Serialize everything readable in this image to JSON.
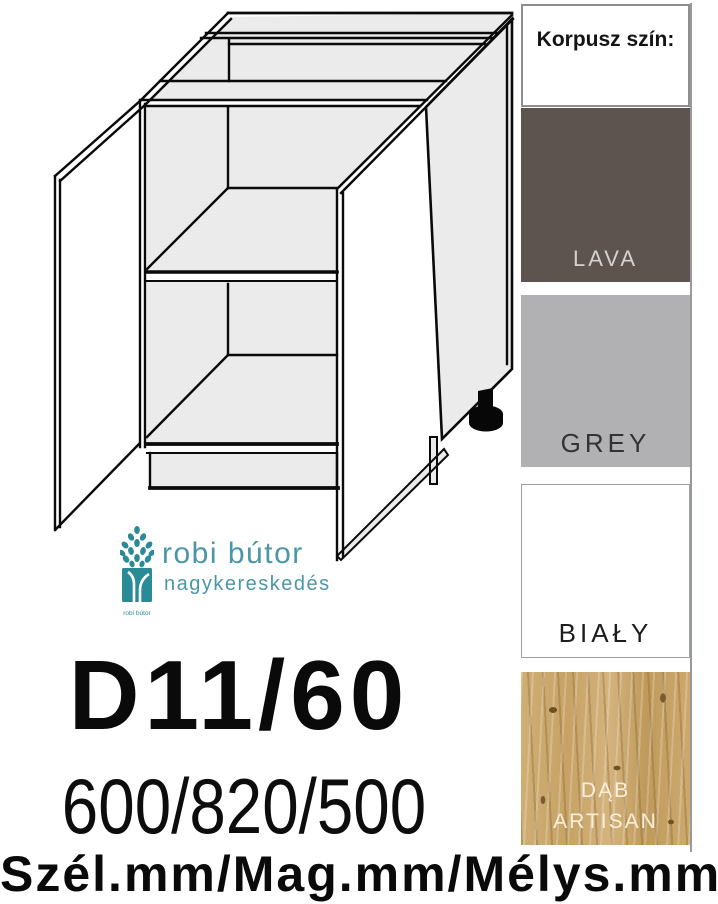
{
  "product": {
    "code": "D11/60",
    "dimensions": "600/820/500",
    "dimension_caption": "Szél.mm/Mag.mm/Mélys.mm"
  },
  "logo": {
    "name": "robi bútor",
    "subtitle": "nagykereskedés",
    "icon": "tree-icon",
    "icon_caption": "robi bútor",
    "accent_color": "#2a8a96",
    "text_color": "#4b97a6"
  },
  "drawing": {
    "subject": "two-door base cabinet with middle shelf, open doors and adjustable foot",
    "style": "isometric line drawing",
    "fill_color": "#ebebec",
    "line_color": "#0a0a0a"
  },
  "sidebar": {
    "title": "Korpusz szín:",
    "swatches": [
      {
        "label": "LAVA",
        "color": "#5d5450",
        "label_color": "#d6d1ce"
      },
      {
        "label": "GREY",
        "color": "#b1b0b3",
        "label_color": "#333333"
      },
      {
        "label": "BIAŁY",
        "color": "#ffffff",
        "label_color": "#1d1d1d"
      },
      {
        "label": "DĄB ARTISAN",
        "color": "#c9a76c",
        "label_color": "#f7efdc"
      }
    ]
  }
}
